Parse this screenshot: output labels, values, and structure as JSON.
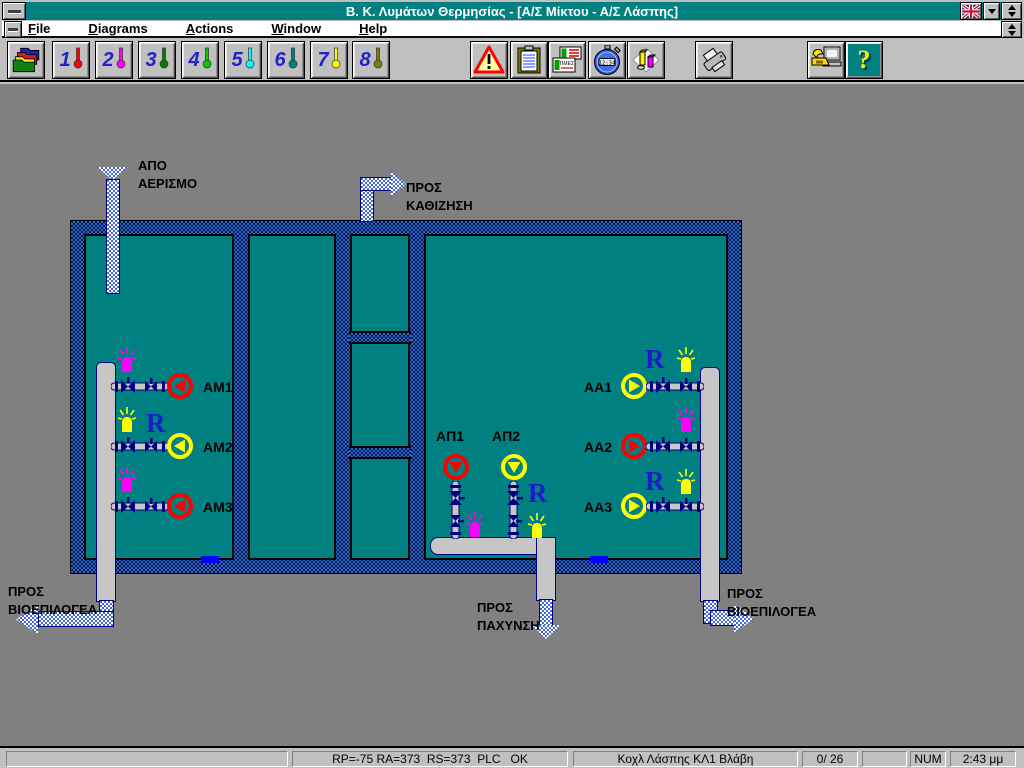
{
  "titlebar": {
    "title": "Β. Κ. Λυμάτων Θερμησίας - [Α/Σ Μίκτου - Α/Σ Λάσπης]"
  },
  "menubar": {
    "items": [
      {
        "label": "File"
      },
      {
        "label": "Diagrams"
      },
      {
        "label": "Actions"
      },
      {
        "label": "Window"
      },
      {
        "label": "Help"
      }
    ]
  },
  "toolbar": {
    "diagram_buttons": [
      {
        "num": "1",
        "color": "#ff0000"
      },
      {
        "num": "2",
        "color": "#ff00ff"
      },
      {
        "num": "3",
        "color": "#008000"
      },
      {
        "num": "4",
        "color": "#00cc00"
      },
      {
        "num": "5",
        "color": "#00ffff"
      },
      {
        "num": "6",
        "color": "#008080"
      },
      {
        "num": "7",
        "color": "#ffff00"
      },
      {
        "num": "8",
        "color": "#808000"
      }
    ],
    "times_label": "ΤΙΜΕΣ",
    "stopwatch_time": "12:34",
    "help_glyph": "?"
  },
  "diagram": {
    "labels": {
      "from_aeration": {
        "line1": "ΑΠΟ",
        "line2": "ΑΕΡΙΣΜΟ"
      },
      "to_sedimentation": {
        "line1": "ΠΡΟΣ",
        "line2": "ΚΑΘΙΖΗΣΗ"
      },
      "to_bioselector_left": {
        "line1": "ΠΡΟΣ",
        "line2": "ΒΙΟΕΠΙΛΟΓΕΑ"
      },
      "to_thickening": {
        "line1": "ΠΡΟΣ",
        "line2": "ΠΑΧΥΝΣΗ"
      },
      "to_bioselector_right": {
        "line1": "ΠΡΟΣ",
        "line2": "ΒΙΟΕΠΙΛΟΓΕΑ"
      }
    },
    "colors": {
      "level_marker": "#0000ff"
    },
    "pumps_left": [
      {
        "label": "AM1",
        "pump_color": "#ff0000",
        "beacon_color": "#ff00ff"
      },
      {
        "label": "AM2",
        "pump_color": "#ffff00",
        "beacon_color": "#ffff00",
        "r": "R"
      },
      {
        "label": "AM3",
        "pump_color": "#ff0000",
        "beacon_color": "#ff00ff"
      }
    ],
    "pumps_right": [
      {
        "label": "AA1",
        "pump_color": "#ffff00",
        "beacon_color": "#ffff00",
        "r": "R"
      },
      {
        "label": "AA2",
        "pump_color": "#ff0000",
        "beacon_color": "#ff00ff"
      },
      {
        "label": "AA3",
        "pump_color": "#ffff00",
        "beacon_color": "#ffff00",
        "r": "R"
      }
    ],
    "pumps_middle": [
      {
        "label": "ΑΠ1",
        "pump_color": "#ff0000",
        "beacon_color": "#ff00ff"
      },
      {
        "label": "ΑΠ2",
        "pump_color": "#ffff00",
        "beacon_color": "#ffff00",
        "r": "R"
      }
    ]
  },
  "statusbar": {
    "plc_status": "RP=-75 RA=373  RS=373  PLC   OK",
    "alarm_message": "Κοχλ Λάσπης ΚΛ1 Βλάβη",
    "alarm_counter": "0/ 26",
    "num_lock": "NUM",
    "time": "2:43 μμ"
  }
}
